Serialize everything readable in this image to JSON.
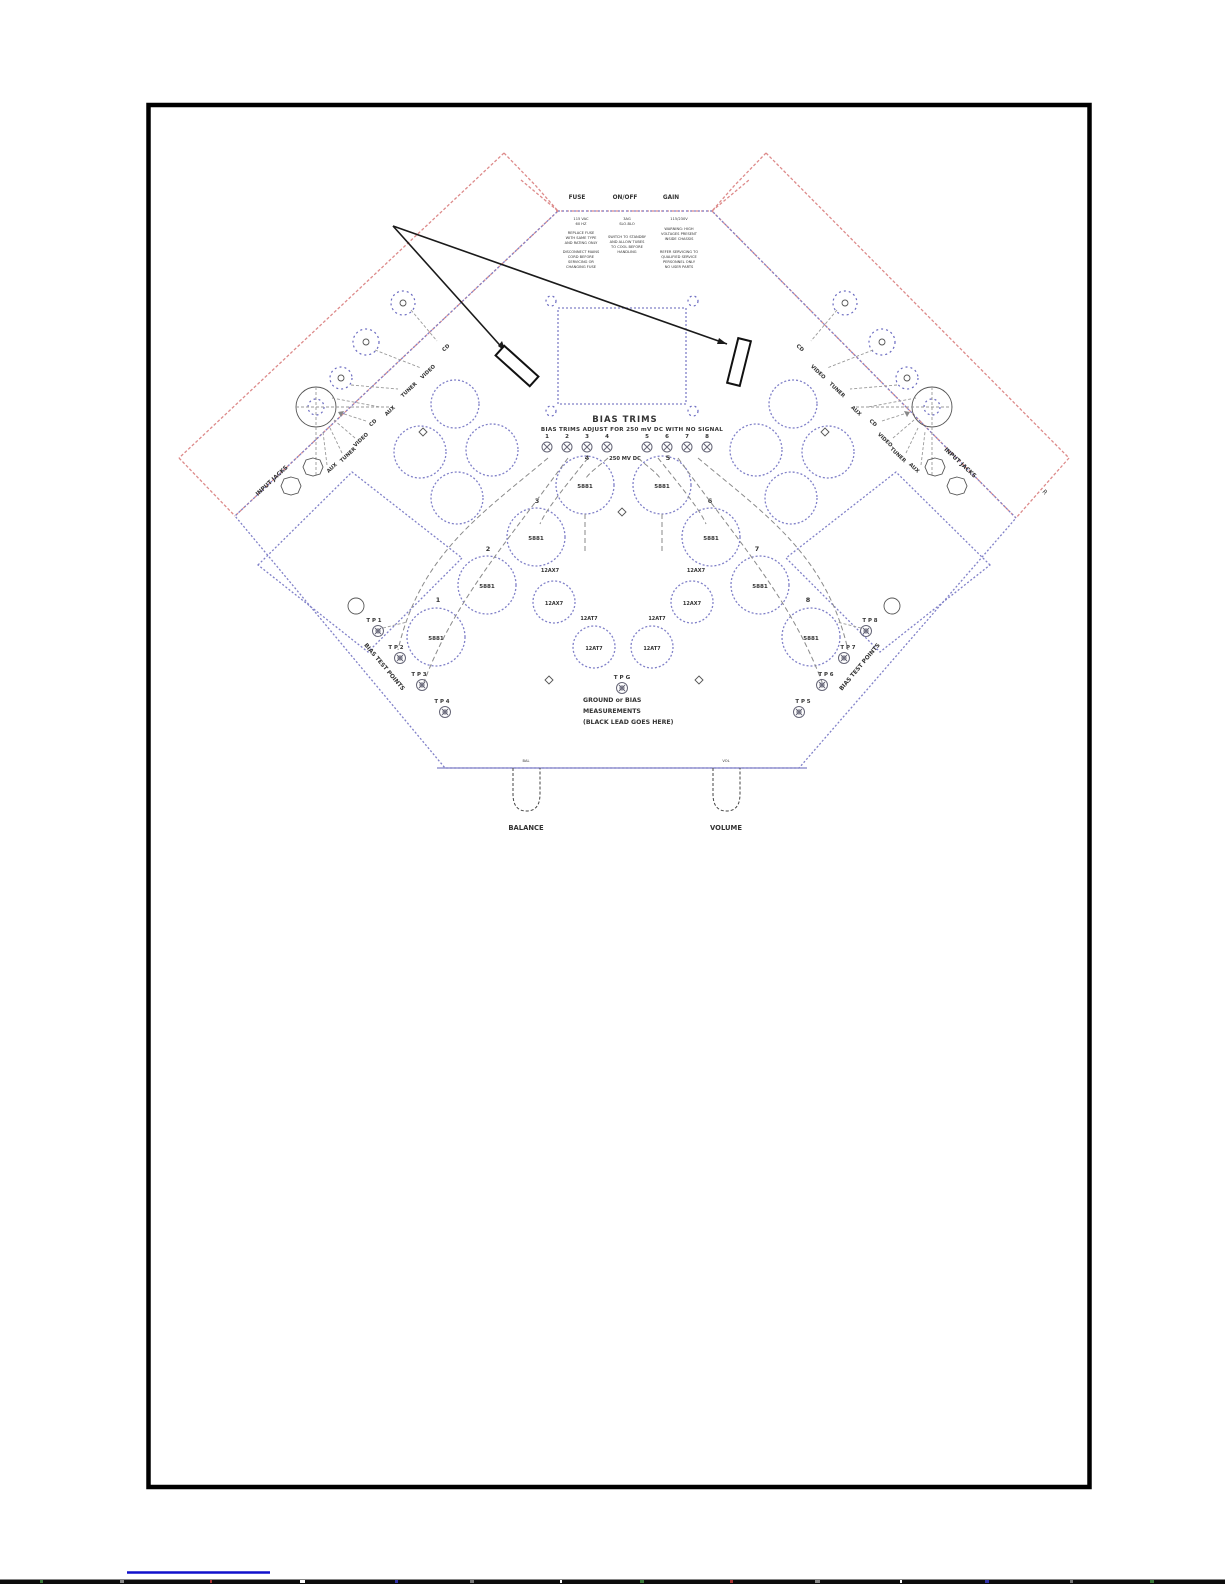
{
  "panel": {
    "rear_switches": [
      "FUSE",
      "ON/OFF",
      "GAIN"
    ],
    "fineprint": {
      "col1": {
        "header": [
          "115 VAC",
          "60 HZ"
        ],
        "para1": [
          "REPLACE FUSE",
          "WITH SAME TYPE",
          "AND RATING ONLY"
        ],
        "para2": [
          "DISCONNECT MAINS",
          "CORD BEFORE",
          "SERVICING OR",
          "CHANGING FUSE"
        ]
      },
      "col2": {
        "header": [
          "3AG",
          "SLO-BLO"
        ],
        "para": [
          "SWITCH TO STANDBY",
          "AND ALLOW TUBES",
          "TO COOL BEFORE",
          "HANDLING"
        ]
      },
      "col3": {
        "header": [
          "115/230V"
        ],
        "para1": [
          "WARNING: HIGH",
          "VOLTAGES PRESENT",
          "INSIDE CHASSIS"
        ],
        "para2": [
          "REFER SERVICING TO",
          "QUALIFIED SERVICE",
          "PERSONNEL ONLY",
          "NO USER PARTS"
        ]
      }
    },
    "bias": {
      "title": "BIAS TRIMS",
      "instruction": "BIAS TRIMS   ADJUST FOR 250 mV DC   WITH NO SIGNAL",
      "trim_numbers": [
        "1",
        "2",
        "3",
        "4",
        "5",
        "6",
        "7",
        "8"
      ],
      "center_note": "250 MV DC"
    },
    "tubes": {
      "power_label": "5881",
      "power_numbers": [
        "1",
        "2",
        "3",
        "4",
        "5",
        "6",
        "7",
        "8"
      ],
      "driver1_label": "12AX7",
      "driver2_label": "12AT7"
    },
    "test_points": {
      "left": [
        "T P 1",
        "T P 2",
        "T P 3",
        "T P 4"
      ],
      "right": [
        "T P 8",
        "T P 7",
        "T P 6",
        "T P 5"
      ],
      "ground_label": "T P G",
      "ground_note": [
        "GROUND or BIAS",
        "MEASUREMENTS",
        "(BLACK LEAD GOES HERE)"
      ]
    },
    "inputs": {
      "labels": [
        "CD",
        "VIDEO",
        "TUNER",
        "AUX"
      ],
      "left_edge_label": "INPUT JACKS",
      "right_edge_label": "INPUT JACKS"
    },
    "bias_edge_label": "BIAS TEST POINTS",
    "front": {
      "balance": "BALANCE",
      "volume": "VOLUME",
      "balance_small": "BAL",
      "volume_small": "VOL"
    },
    "corner_mark": "R"
  }
}
